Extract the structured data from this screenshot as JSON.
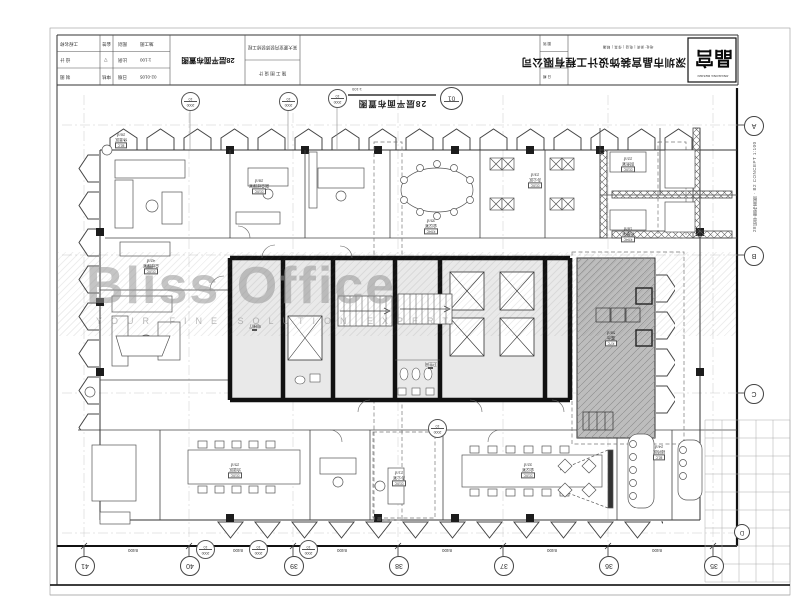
{
  "watermark": {
    "title": "Bliss Office",
    "subtitle": "YOUR FINE SOLUTION EXPERT"
  },
  "plan_label": {
    "no": "01",
    "title": "28层平面布置图",
    "scale": "1:100"
  },
  "title_block": {
    "r1c1": "工程名称",
    "r1c2": "会签",
    "r1c3": "图别",
    "r1c4": "施工图",
    "r2c1": "设 计",
    "r2c2": "▽",
    "r2c3": "比例",
    "r2c4": "1:100",
    "r3c1": "制 图",
    "r3c2": "审核",
    "r3c3": "日期",
    "r3c4": "02-0105",
    "title_cell": "28层平面布置图",
    "project_line1": "某大厦室内装饰装修工程",
    "project_line2": "施 工 图 设 计",
    "info1": "图 别",
    "info2": "图 号",
    "info3": "日 期",
    "company_small": "地址·深圳  |  电话  |  传真  |  邮编",
    "company": "深圳市晶宫装饰设计工程有限公司",
    "logo_main": "晶宫",
    "logo_sub": "JINGGONG DESIGN"
  },
  "stamp_right": "28层平面布置图 · B2 CONCEPT 1:100",
  "grid": {
    "bottom": [
      "41",
      "40",
      "39",
      "38",
      "37",
      "36",
      "35"
    ],
    "right": [
      "A",
      "B",
      "C",
      "D"
    ],
    "callout_top": "2000",
    "callout_bot": "10",
    "dims": [
      "8400",
      "8400",
      "8400",
      "8400",
      "8400",
      "8400"
    ]
  },
  "rooms": [
    {
      "c": "B1C",
      "n": "休息区",
      "a": "26㎡"
    },
    {
      "c": "D10C",
      "n": "总经理室",
      "a": "42㎡"
    },
    {
      "c": "D10C",
      "n": "副总经理室",
      "a": "28㎡"
    },
    {
      "c": "K04C",
      "n": "会议室",
      "a": "35㎡"
    },
    {
      "c": "D10C",
      "n": "办公区",
      "a": "23㎡"
    },
    {
      "c": "D10C",
      "n": "财务室",
      "a": "22㎡"
    },
    {
      "c": "K04C",
      "n": "档案室",
      "a": "18㎡"
    },
    {
      "c": "D10C",
      "n": "洽谈区",
      "a": "25㎡"
    },
    {
      "c": "D10C",
      "n": "会议室",
      "a": "32㎡"
    },
    {
      "c": "B1C",
      "n": "接待区",
      "a": "24㎡"
    },
    {
      "c": "K7C",
      "n": "露台",
      "a": "58㎡"
    },
    {
      "c": "",
      "n": "电梯厅",
      "a": ""
    },
    {
      "c": "",
      "n": "卫生间",
      "a": ""
    },
    {
      "c": "D10C",
      "n": "办公室",
      "a": "21㎡"
    }
  ]
}
